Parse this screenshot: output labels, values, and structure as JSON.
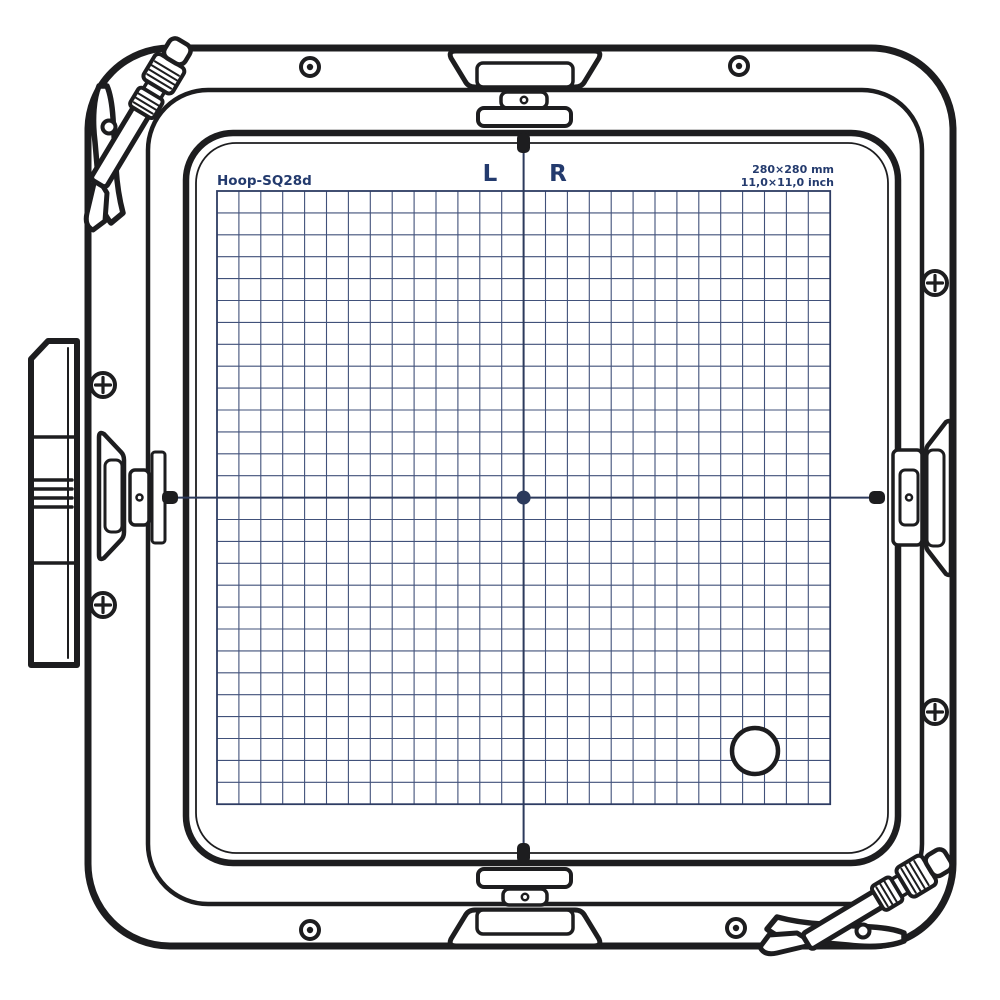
{
  "hoop": {
    "model": "Hoop-SQ28d",
    "label_left": "L",
    "label_right": "R",
    "size_metric": "280×280 mm",
    "size_imperial": "11,0×11,0 inch"
  },
  "grid": {
    "columns": 28,
    "rows": 28,
    "x": 217,
    "y": 191,
    "cell": 21.9
  },
  "center_marker": {
    "x": 523.6,
    "y": 497.6,
    "dot_radius": 7,
    "crosshair": {
      "x1": 172,
      "x2": 872,
      "y1": 150,
      "y2": 847
    }
  },
  "template_hole": {
    "cx": 755,
    "cy": 751,
    "r": 23
  },
  "colors": {
    "line": "#1d1d1f",
    "grid_line": "#41517a",
    "grid_border": "#2e3c63",
    "crosshair": "#2c3a5c",
    "text": "#233a6d",
    "background": "#ffffff"
  }
}
